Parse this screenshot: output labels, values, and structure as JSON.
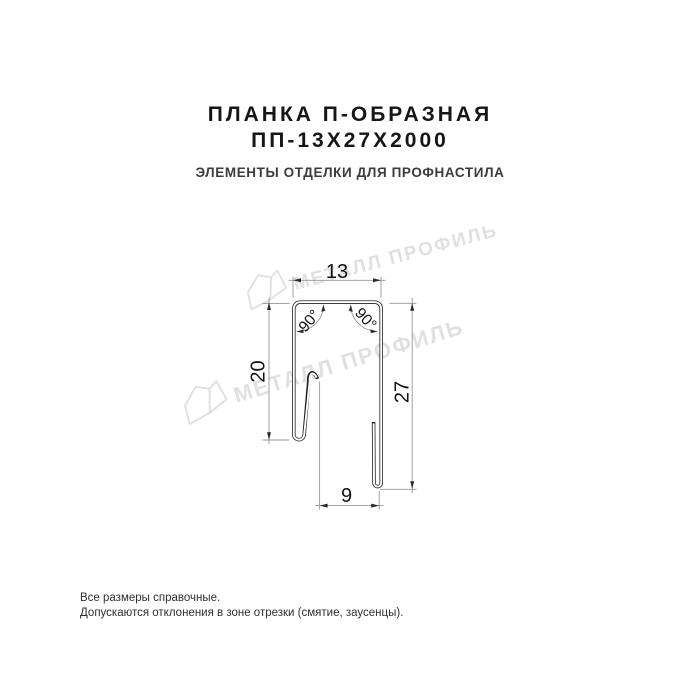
{
  "header": {
    "title_line1": "ПЛАНКА П-ОБРАЗНАЯ",
    "title_line2": "ПП-13Х27Х2000",
    "subtitle": "ЭЛЕМЕНТЫ ОТДЕЛКИ ДЛЯ ПРОФНАСТИЛА"
  },
  "drawing": {
    "type": "technical-cross-section",
    "dim_top_width": "13",
    "dim_left_height": "20",
    "dim_right_height": "27",
    "dim_bottom_width": "9",
    "angle_left": "90°",
    "angle_right": "90°"
  },
  "watermark": {
    "text": "МЕТАЛЛ ПРОФИЛЬ"
  },
  "footer": {
    "note_line1": "Все размеры справочные.",
    "note_line2": "Допускаются отклонения в зоне отрезки (смятие, заусенцы)."
  },
  "colors": {
    "profile_line": "#202020",
    "dimension_line": "#969696",
    "arrow": "#2b2b2b",
    "watermark": "#dfe1e1",
    "title": "#161616",
    "subtitle": "#3c3c3c"
  }
}
